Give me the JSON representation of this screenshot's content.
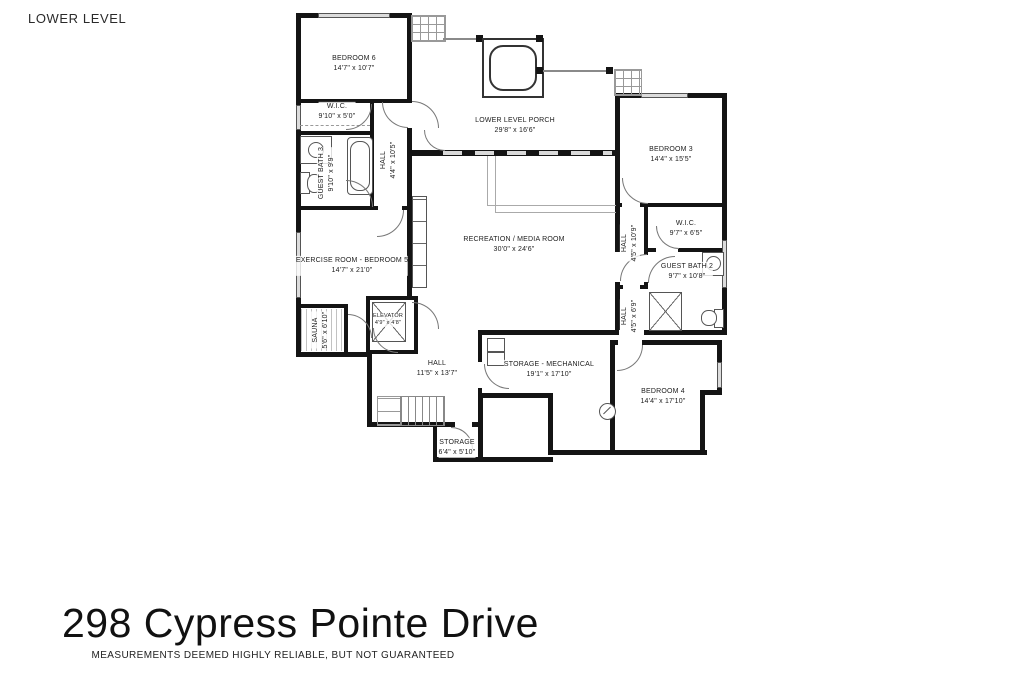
{
  "page": {
    "level_label": "LOWER LEVEL",
    "address": "298 Cypress Pointe Drive",
    "disclaimer": "MEASUREMENTS DEEMED HIGHLY RELIABLE, BUT NOT GUARANTEED"
  },
  "rooms": {
    "bedroom6": {
      "name": "BEDROOM 6",
      "dims": "14'7\" x 10'7\""
    },
    "wic1": {
      "name": "W.I.C.",
      "dims": "9'10\" x 5'0\""
    },
    "guest_bath3": {
      "name": "GUEST BATH 3",
      "dims": "9'10\" x 9'9\""
    },
    "hall1": {
      "name": "HALL",
      "dims": "4'4\" x 10'5\""
    },
    "porch": {
      "name": "LOWER LEVEL PORCH",
      "dims": "29'8\" x 16'6\""
    },
    "bedroom3": {
      "name": "BEDROOM 3",
      "dims": "14'4\" x 15'5\""
    },
    "rec": {
      "name": "RECREATION / MEDIA ROOM",
      "dims": "30'0\" x 24'6\""
    },
    "exercise": {
      "name": "EXERCISE ROOM - BEDROOM 5",
      "dims": "14'7\" x 21'0\""
    },
    "hall2": {
      "name": "HALL",
      "dims": "4'5\" x 10'9\""
    },
    "wic2": {
      "name": "W.I.C.",
      "dims": "9'7\" x 6'5\""
    },
    "guest_bath2": {
      "name": "GUEST BATH 2",
      "dims": "9'7\" x 10'8\""
    },
    "hall3": {
      "name": "HALL",
      "dims": "4'5\" x 6'9\""
    },
    "sauna": {
      "name": "SAUNA",
      "dims": "5'6\" x 6'10\""
    },
    "elevator": {
      "name": "ELEVATOR",
      "dims": "4'9\" x 4'8\""
    },
    "hall4": {
      "name": "HALL",
      "dims": "11'5\" x 13'7\""
    },
    "storage_mech": {
      "name": "STORAGE - MECHANICAL",
      "dims": "19'1\" x 17'10\""
    },
    "storage": {
      "name": "STORAGE",
      "dims": "6'4\" x 5'10\""
    },
    "bedroom4": {
      "name": "BEDROOM 4",
      "dims": "14'4\" x 17'10\""
    }
  }
}
